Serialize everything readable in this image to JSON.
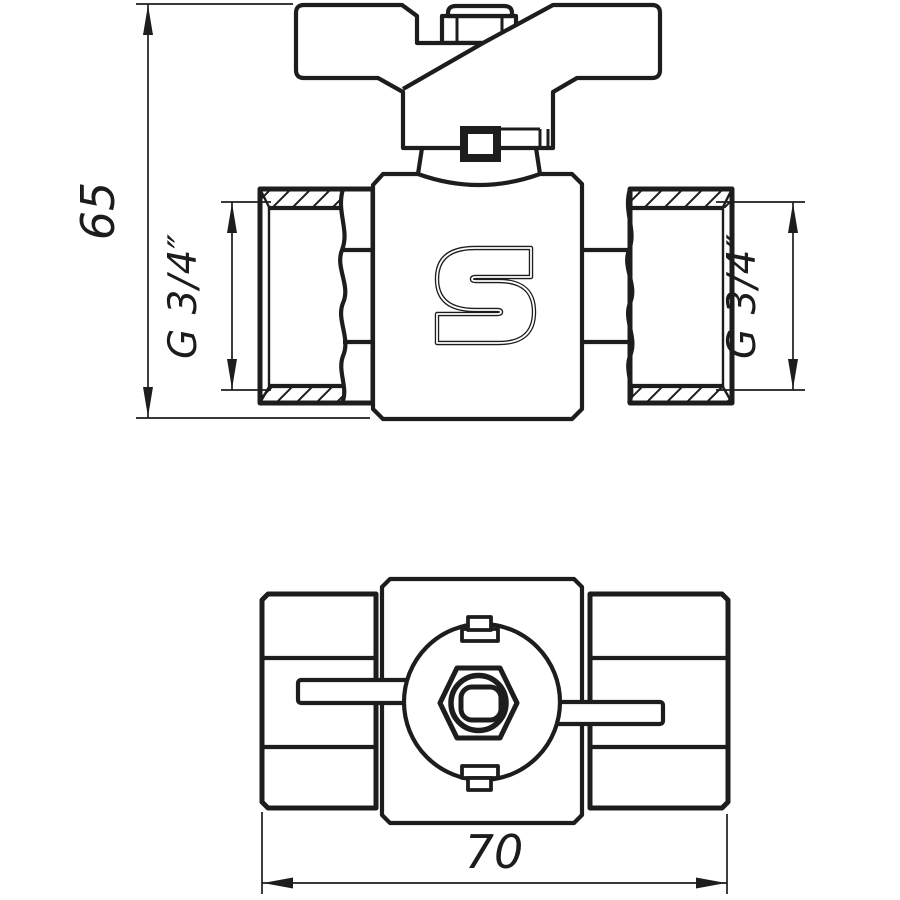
{
  "colors": {
    "background": "#ffffff",
    "line": "#1d1d1d"
  },
  "logo": {
    "letter": "S"
  },
  "dimensions": {
    "overall_height": "65",
    "overall_width": "70",
    "thread_size_left": "G 3/4″",
    "thread_size_right": "G 3/4″"
  }
}
